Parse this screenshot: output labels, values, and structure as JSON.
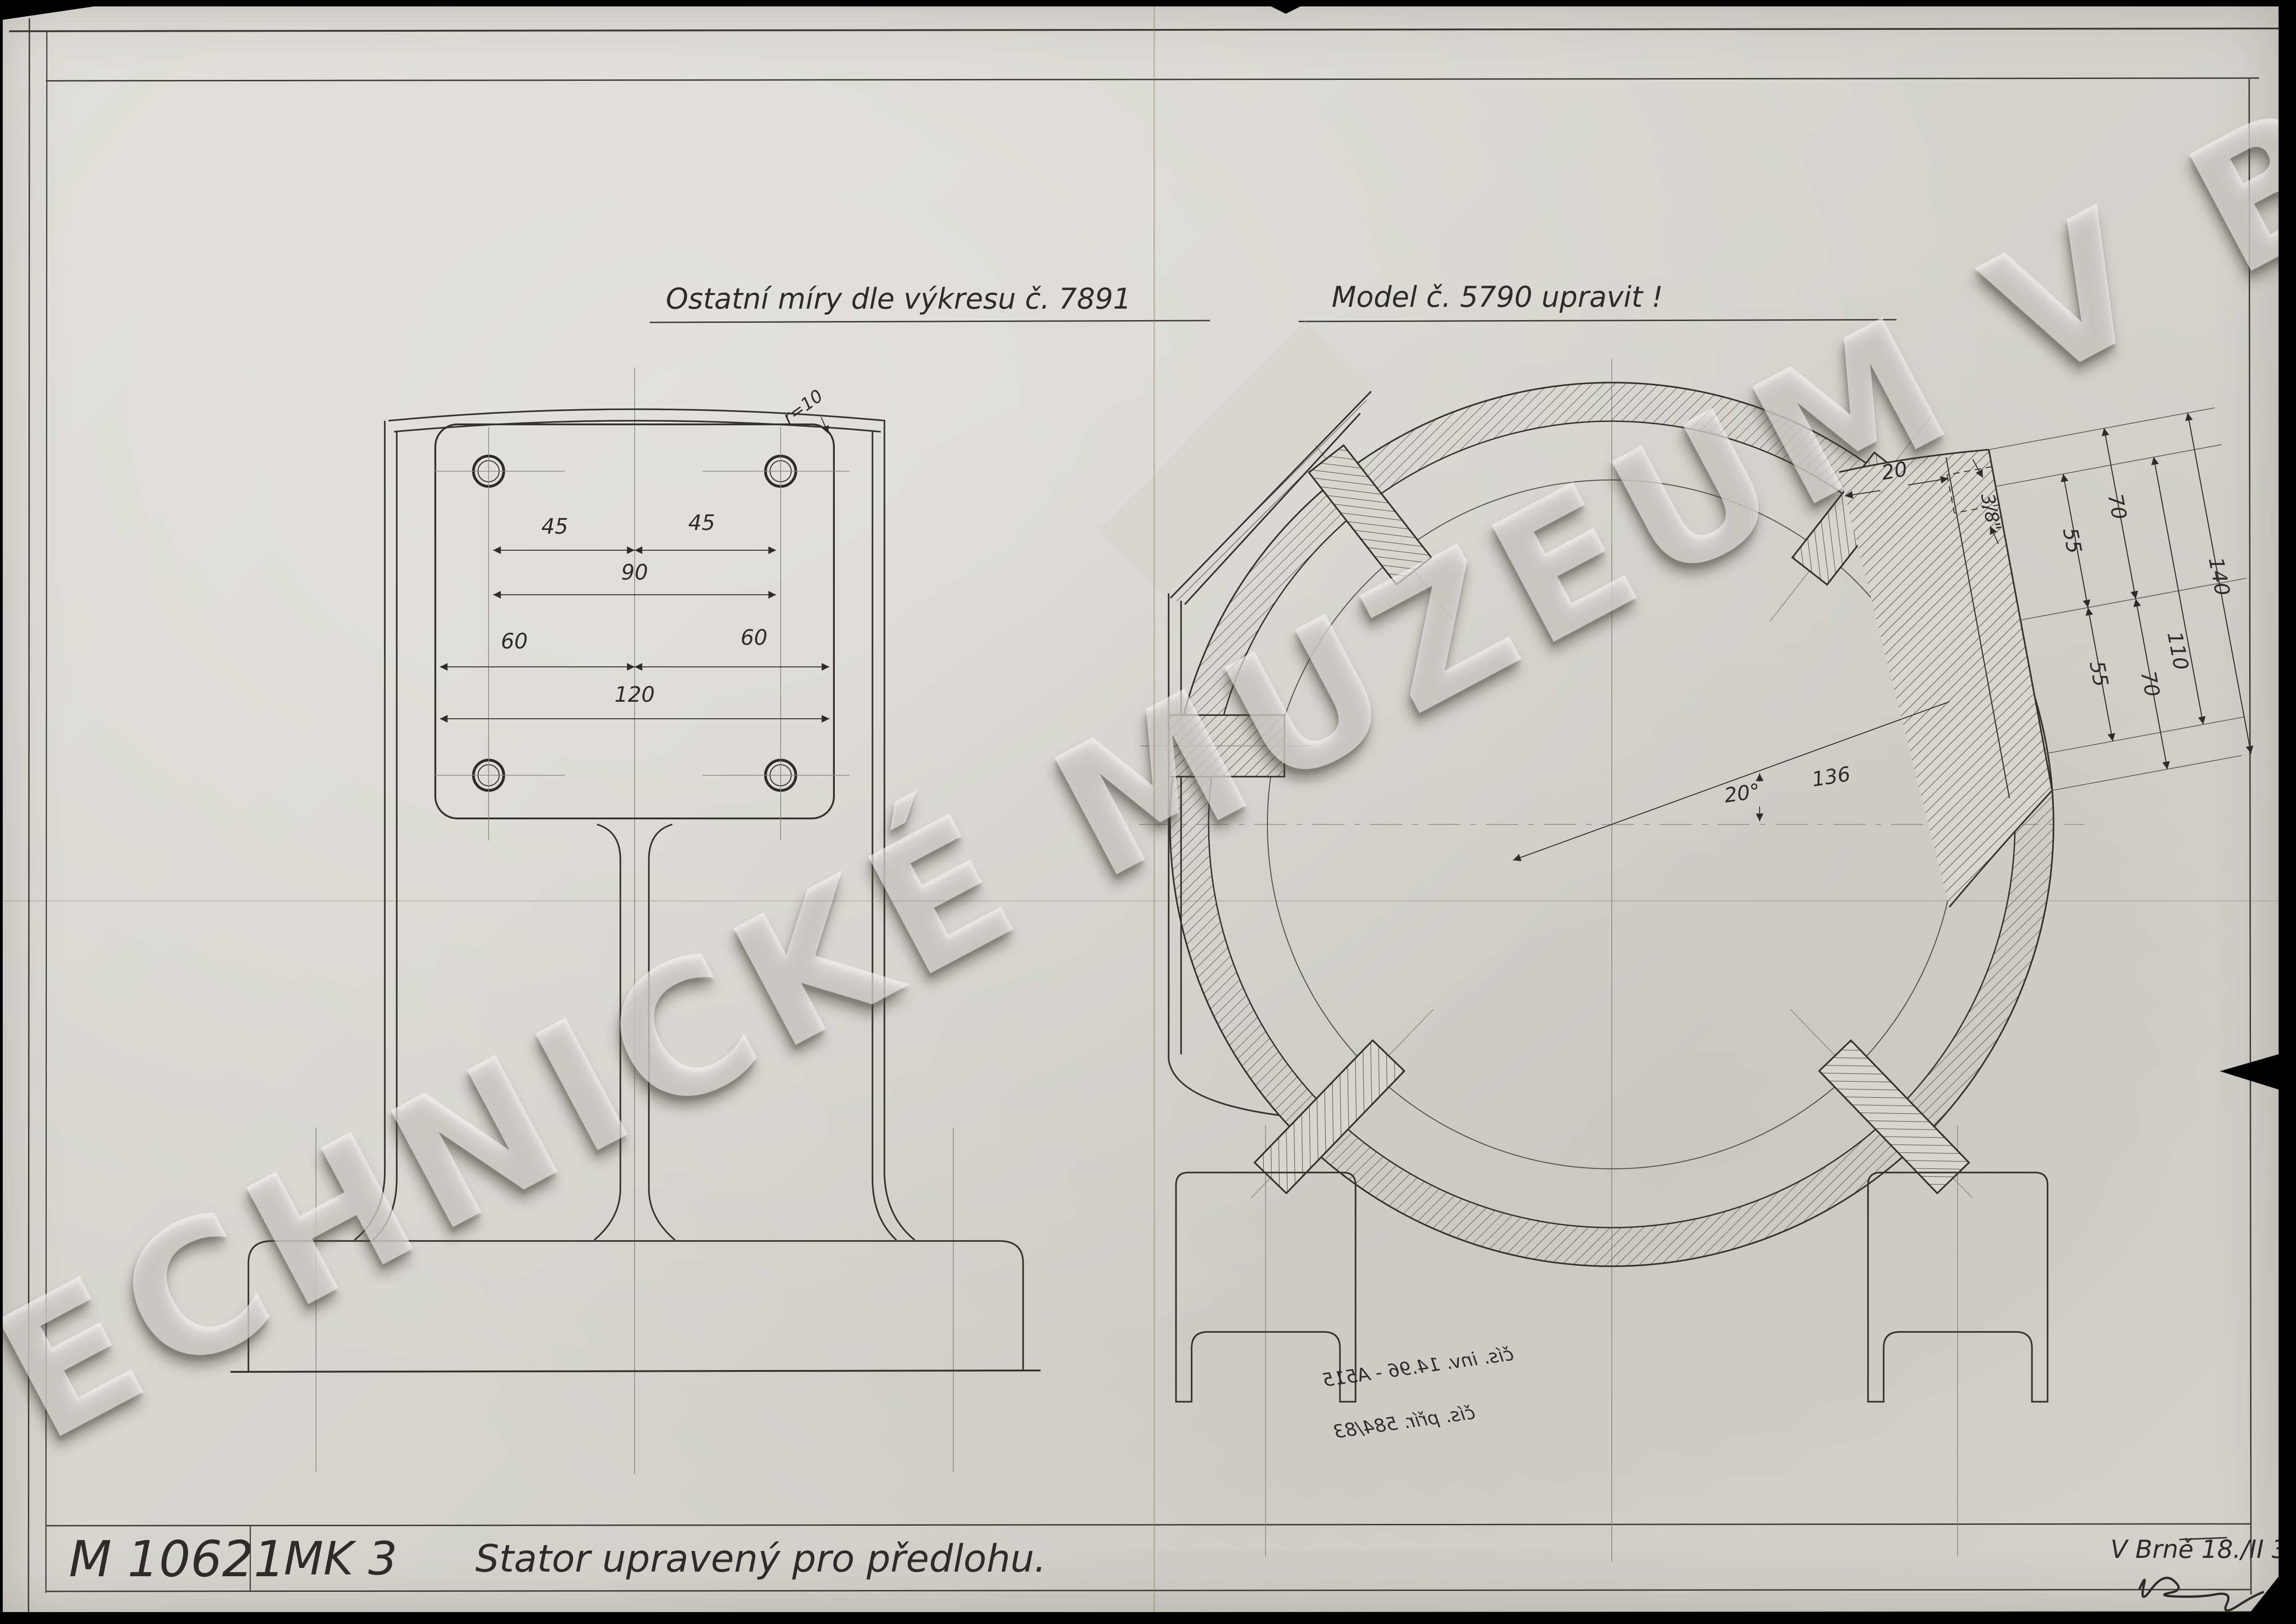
{
  "sheet": {
    "background": "#d6d5d0",
    "ink_color": "#2e2c28",
    "watermark": {
      "text": "TECHNICKÉ MUZEUM V BRNĚ"
    }
  },
  "notes": {
    "left_note": "Ostatní míry dle výkresu č. 7891",
    "right_note": "Model č. 5790 upravit !"
  },
  "title_block": {
    "drawing_number": "M 10621",
    "model_code": "MK 3",
    "title": "Stator upravený pro předlohu.",
    "place_date": "V Brně 18./II 30",
    "signature_present": true
  },
  "stamp_bleedthrough": {
    "line1": "čís. inv. 14.96 - A515",
    "line2": "čís. přír. 584/83",
    "mirrored": true
  },
  "left_view": {
    "dim_45_left": "45",
    "dim_45_right": "45",
    "dim_90": "90",
    "dim_60_left": "60",
    "dim_60_right": "60",
    "dim_120": "120",
    "corner_radius": "r=10"
  },
  "right_view": {
    "dim_pad_depth": "20",
    "dim_thread": "3/8\"",
    "dim_55_upper": "55",
    "dim_70_upper": "70",
    "dim_55_lower": "55",
    "dim_70_lower": "70",
    "dim_110": "110",
    "dim_140": "140",
    "angle": "20°",
    "radius": "136"
  }
}
